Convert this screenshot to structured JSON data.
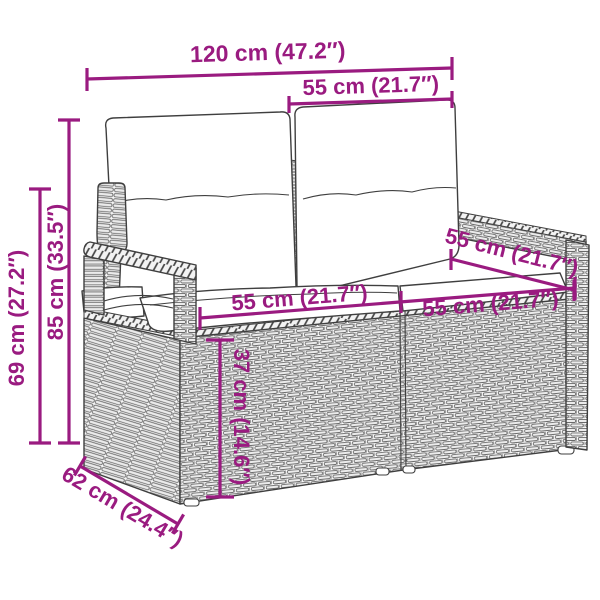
{
  "figure": {
    "description": "Dimension diagram of a poly rattan two-seater garden sofa with back and seat cushions",
    "colors": {
      "dimension": "#9A1B80",
      "outline": "#3f3f3f",
      "texture": "#6a6a6a",
      "background": "#ffffff"
    },
    "dims": {
      "width_total": "120 cm (47.2″)",
      "back_section_width": "55 cm (21.7″)",
      "height_total": "85 cm (33.5″)",
      "armrest_height": "69 cm (27.2″)",
      "seat_width_left": "55 cm (21.7″)",
      "seat_width_right": "55 cm (21.7″)",
      "seat_depth": "55 cm (21.7″)",
      "seat_height": "37 cm (14.6″)",
      "depth_total": "62 cm (24.4″)"
    }
  }
}
